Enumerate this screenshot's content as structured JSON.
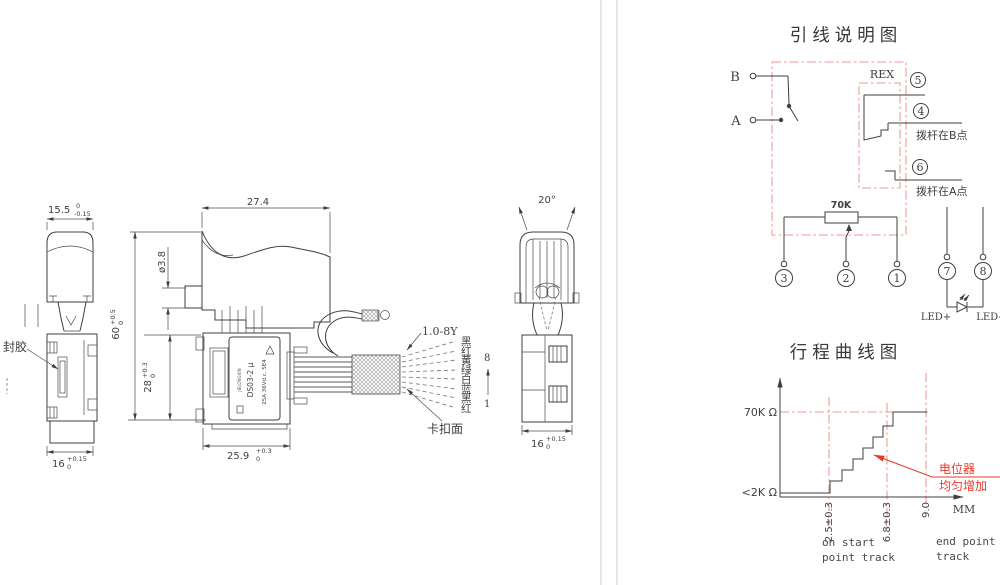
{
  "colors": {
    "line": "#3f3f3f",
    "soft_red": "#f09a94",
    "red": "#e6392a",
    "divider": "#cccccc",
    "background": "#ffffff"
  },
  "views": {
    "side": {
      "dim_top": {
        "v": "15.5",
        "up": "0",
        "dn": "-0.15"
      },
      "dim_bottom": {
        "v": "16",
        "up": "+0.15",
        "dn": "0"
      },
      "seal_label": "封胶"
    },
    "front": {
      "dim_width": "27.4",
      "dim_rod": "ø3.8",
      "dim_height": {
        "v": "60",
        "up": "+0.5",
        "dn": "0"
      },
      "dim_body": {
        "v": "28",
        "up": "+0.3",
        "dn": "0"
      },
      "dim_bottom": {
        "v": "25.9",
        "up": "+0.3",
        "dn": "0"
      },
      "nameplate": {
        "brand": "JIELONGXIN",
        "model": "DS03-2 μ",
        "rating": "25A 36Vd.c. 5E4"
      }
    },
    "rear": {
      "dim_angle": "20°",
      "dim_bottom": {
        "v": "16",
        "up": "+0.15",
        "dn": "0"
      }
    },
    "wires": {
      "spec": "1.0-8Y",
      "clip_label": "卡扣面",
      "colors": [
        "黑",
        "红",
        "黄",
        "绿",
        "白",
        "蓝",
        "黑",
        "红"
      ],
      "pin_top": "8",
      "pin_bottom": "1"
    }
  },
  "wiring": {
    "title": "引线说明图",
    "terminal_b": "B",
    "terminal_a": "A",
    "rex": "REX",
    "pins": {
      "p5": "5",
      "p4": "4",
      "p6": "6",
      "p3": "3",
      "p2": "2",
      "p1": "1",
      "p7": "7",
      "p8": "8"
    },
    "note_b": "拨杆在B点",
    "note_a": "拨杆在A点",
    "pot": "70K",
    "led_plus": "LED+",
    "led_minus": "LED-"
  },
  "curve": {
    "title": "行程曲线图",
    "y_top": "70K Ω",
    "y_bottom": "<2K Ω",
    "x_ticks": [
      "2.5±0.3",
      "6.8±0.3",
      "9.0"
    ],
    "x_unit": "MM",
    "ann_line1": "电位器",
    "ann_line2": "均匀增加",
    "start_note_1": "on start",
    "start_note_2": "point track",
    "end_note_1": "end point",
    "end_note_2": "track"
  },
  "chart_data": {
    "type": "line",
    "title": "行程曲线图",
    "xlabel": "MM",
    "ylabel": "resistance (Ω)",
    "x_ticks": [
      "2.5±0.3",
      "6.8±0.3",
      "9.0"
    ],
    "y_tick_labels": [
      "<2K Ω",
      "70K Ω"
    ],
    "grid": false,
    "legend_position": "none",
    "series": [
      {
        "name": "电位器均匀增加",
        "style": "staircase",
        "points": [
          [
            0,
            "<2K"
          ],
          [
            2.5,
            "<2K"
          ],
          [
            6.8,
            "70K"
          ],
          [
            9.0,
            "70K"
          ]
        ],
        "note": "resistance rises in uniform steps between 2.5±0.3mm and 6.8±0.3mm of travel, then holds 70K to 9.0mm"
      }
    ],
    "annotations": [
      "on start point track",
      "end point track",
      "电位器 均匀增加"
    ]
  }
}
